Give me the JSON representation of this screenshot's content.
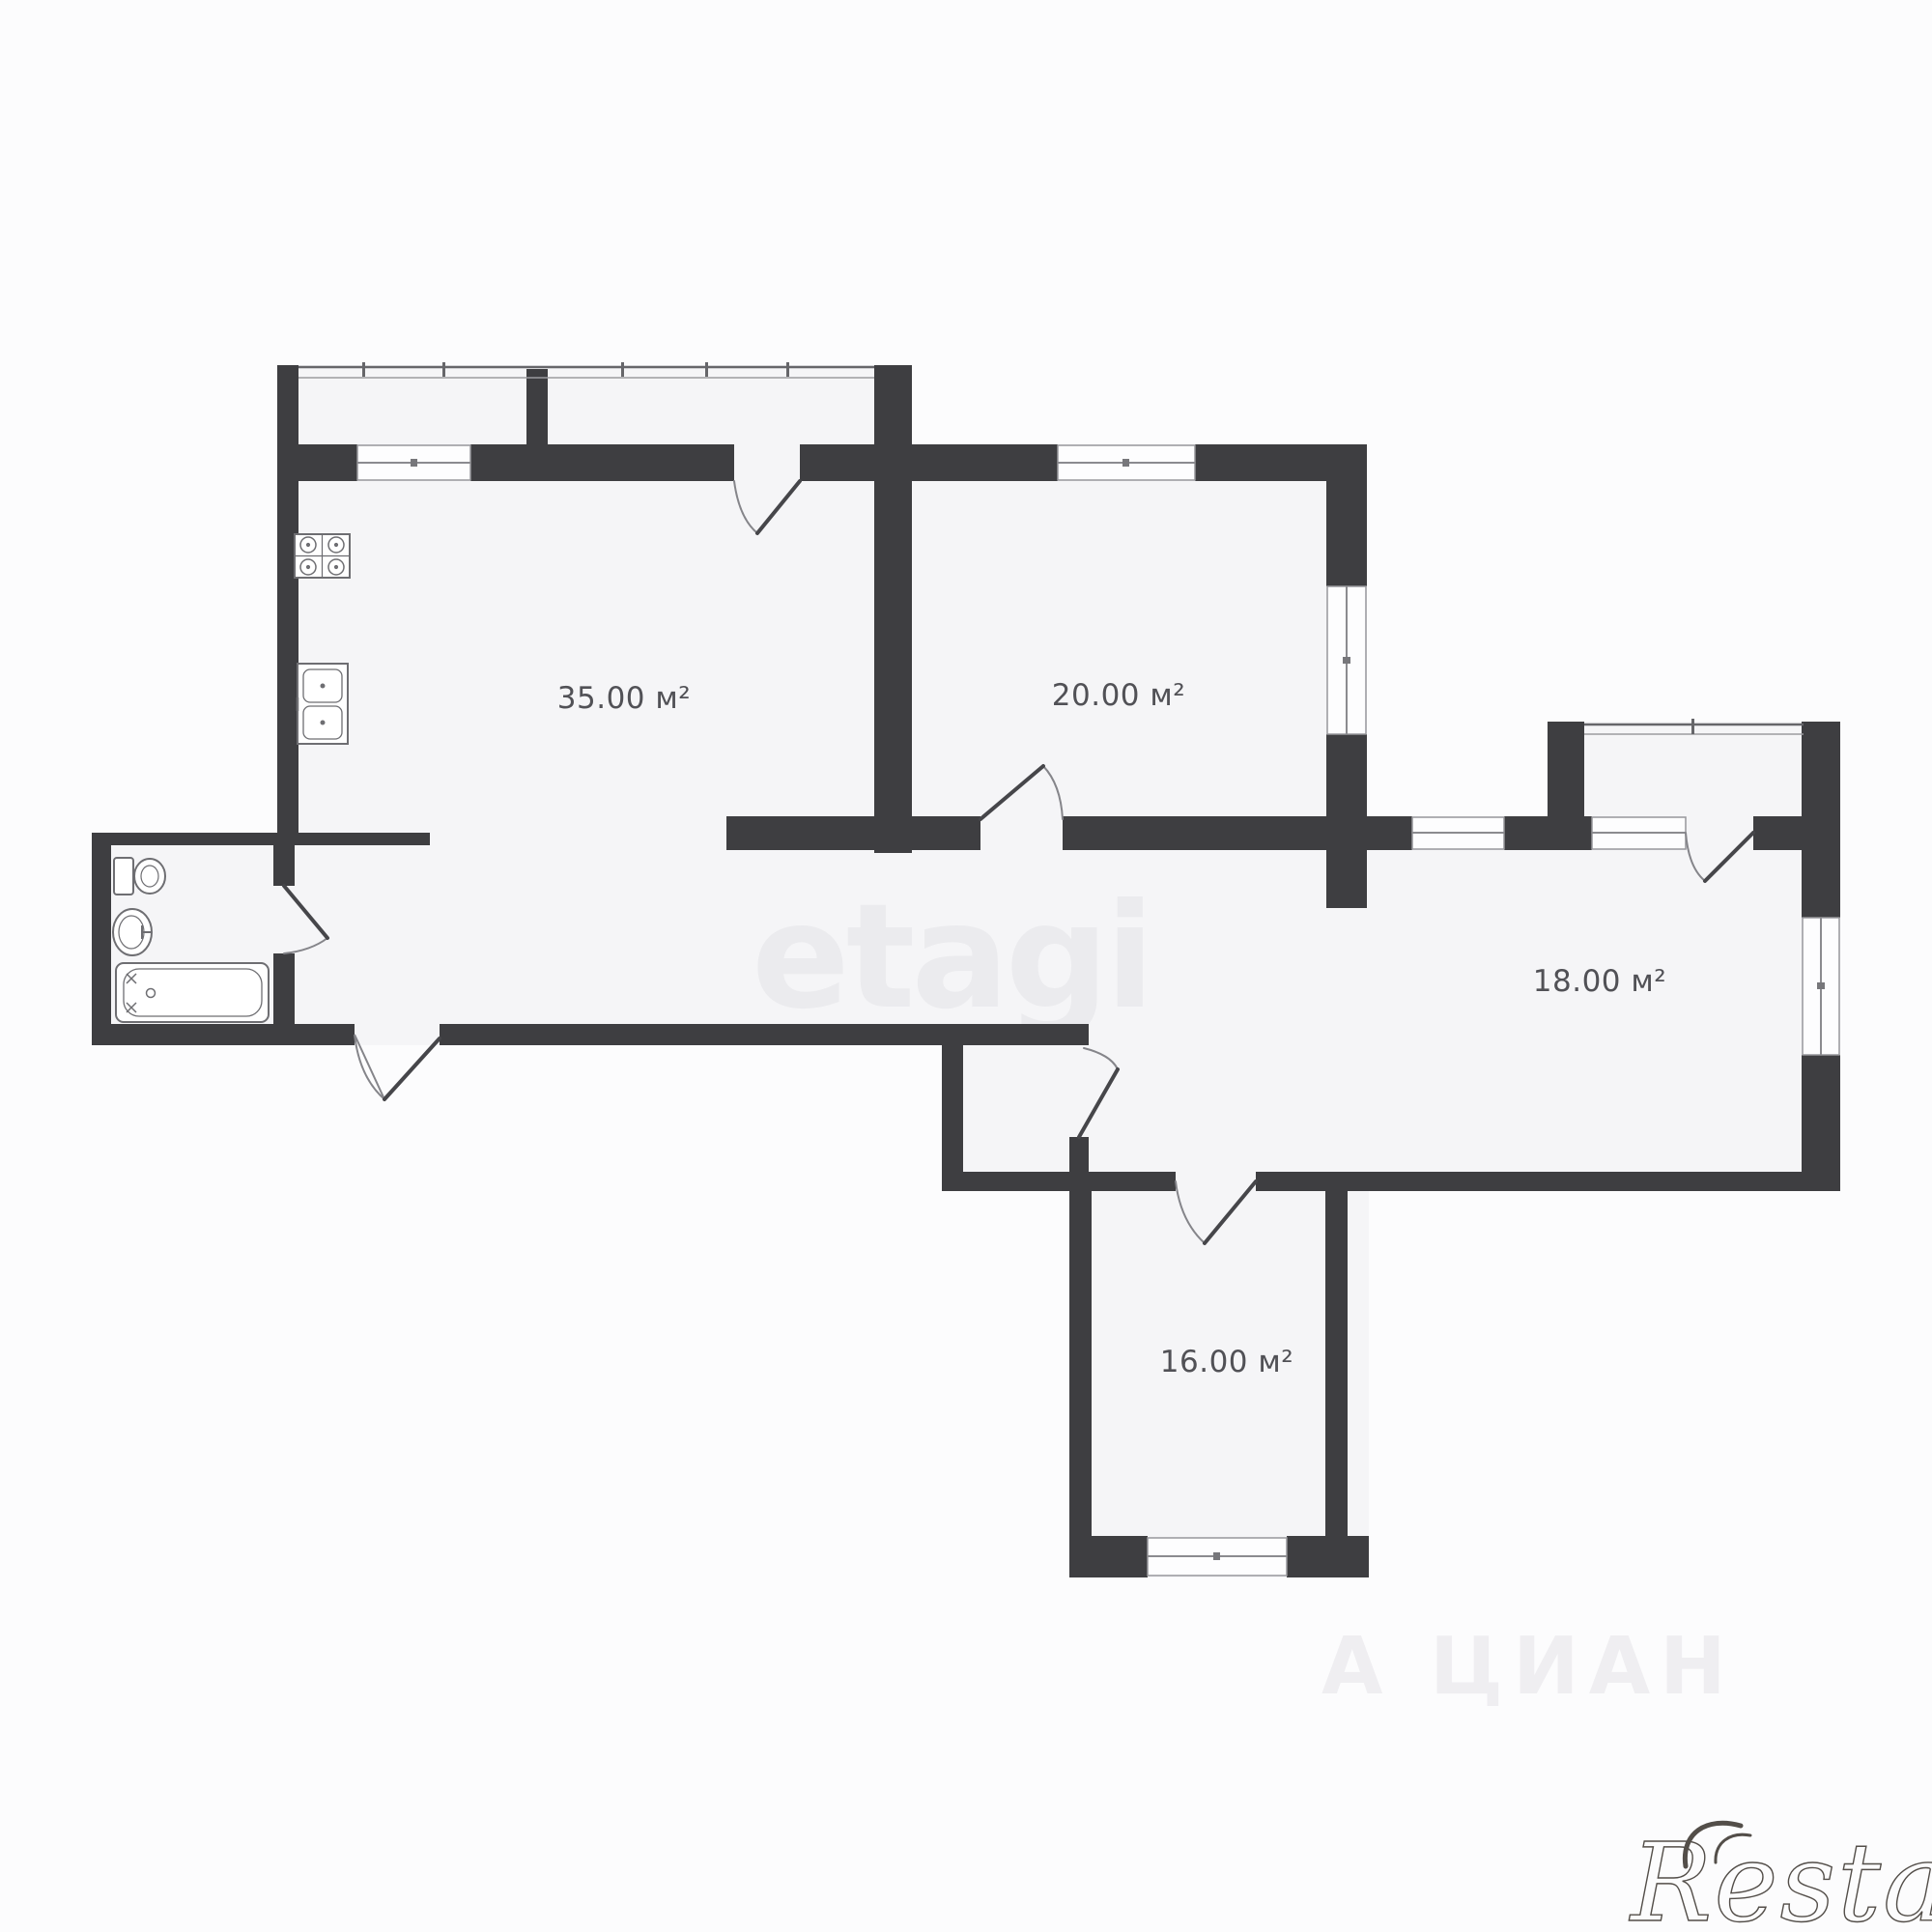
{
  "colors": {
    "wall": "#3e3e41",
    "floor": "#f5f5f7",
    "label": "#515156",
    "fixture": "#6e6e72",
    "window_line": "#97979b",
    "logo": "#534e49"
  },
  "plan": {
    "rooms": [
      {
        "id": "kitchen-living",
        "area_label": "35.00 м²"
      },
      {
        "id": "room-20",
        "area_label": "20.00 м²"
      },
      {
        "id": "room-18",
        "area_label": "18.00 м²"
      },
      {
        "id": "room-16",
        "area_label": "16.00 м²"
      }
    ],
    "fixtures": [
      "stove",
      "kitchen-sink",
      "toilet",
      "wash-basin",
      "bathtub"
    ]
  },
  "watermarks": {
    "center": "etagi",
    "bottom": "А ЦИАН",
    "logo": "Restate"
  }
}
